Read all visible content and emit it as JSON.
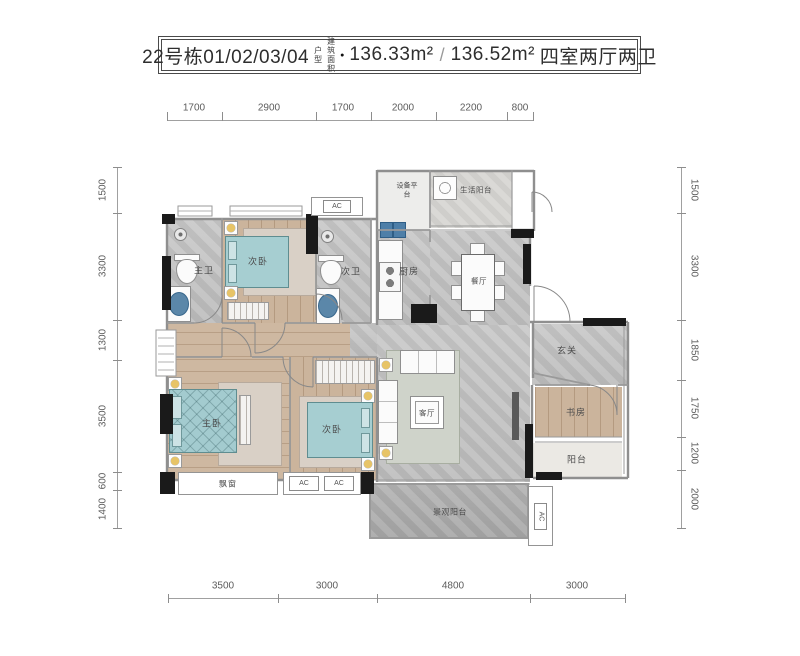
{
  "title": {
    "building_no": "22号栋01/02/03/04",
    "unit_suffix": "户型",
    "area_label": "建筑面积",
    "bullet": "●",
    "area_1": "136.33m²",
    "slash": "/",
    "area_2": "136.52m²",
    "layout_desc": "四室两厅两卫"
  },
  "dims": {
    "top": [
      "1700",
      "2900",
      "1700",
      "2000",
      "2200",
      "800"
    ],
    "left": [
      "1500",
      "3300",
      "1300",
      "3500",
      "600",
      "1400"
    ],
    "right": [
      "1500",
      "3300",
      "1850",
      "1750",
      "1200",
      "2000"
    ],
    "bottom": [
      "3500",
      "3000",
      "4800",
      "3000"
    ]
  },
  "rooms": {
    "master_bath": "主卫",
    "second_bedroom_top": "次卧",
    "second_bath": "次卫",
    "kitchen": "厨房",
    "dining": "餐厅",
    "equipment_platform": "设备平台",
    "life_balcony": "生活阳台",
    "foyer": "玄关",
    "living": "客厅",
    "study": "书房",
    "balcony": "阳台",
    "master_bedroom": "主卧",
    "second_bedroom_bottom": "次卧",
    "bay_window": "飘窗",
    "view_balcony": "景观阳台",
    "ac": "AC"
  },
  "colors": {
    "bed_teal": "#a6ced1",
    "wood_floor": "#c8b097",
    "tile_floor": "#c6c6c6",
    "wall_gray": "#8f8f8f",
    "structural_column": "#1a1a1a",
    "lamp_yellow": "#e7c467",
    "sink_blue": "#5b87a9",
    "label_text": "#4c4c4c"
  }
}
